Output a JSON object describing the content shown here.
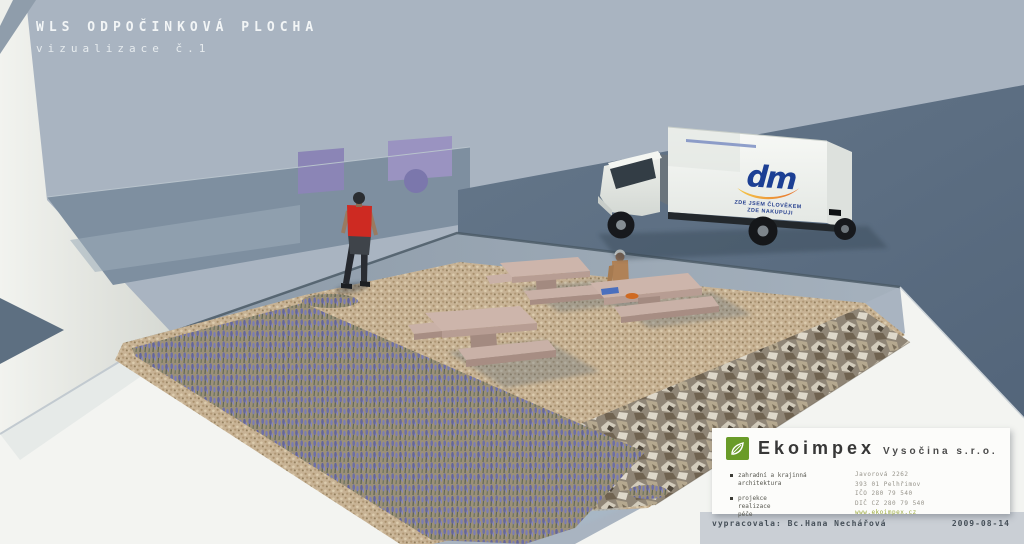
{
  "title": {
    "line1": "WLS ODPOČINKOVÁ PLOCHA",
    "line2": "vizualizace č.1"
  },
  "truck": {
    "brand": "dm",
    "slogan_line1": "ZDE JSEM ČLOVĚKEM",
    "slogan_line2": "ZDE NAKUPUJI"
  },
  "infobox": {
    "brand": "Ekoimpex",
    "suffix": "Vysočina s.r.o.",
    "service1_line1": "zahradní a krajinná",
    "service1_line2": "architektura",
    "service2_line1": "projekce",
    "service2_line2": "realizace",
    "service2_line3": "péče",
    "contact_line1": "Javorová 2262",
    "contact_line2": "393 01 Pelhřimov",
    "contact_line3": "IČO 280 79 540",
    "contact_line4": "DIČ CZ 280 79 540",
    "contact_line5": "www.ekoimpex.cz"
  },
  "credits": {
    "author": "vypracovala: Bc.Hana Nechářová",
    "date": "2009-08-14"
  },
  "colors": {
    "accent_green": "#699b28",
    "dm_blue": "#1c3f94",
    "dm_orange": "#e7702b",
    "shirt_red": "#ce2a22",
    "lavender": "#6f72aa",
    "gravel": "#c7b294",
    "wall_light": "#a9b4c1",
    "wall_dark": "#5c6e80"
  }
}
